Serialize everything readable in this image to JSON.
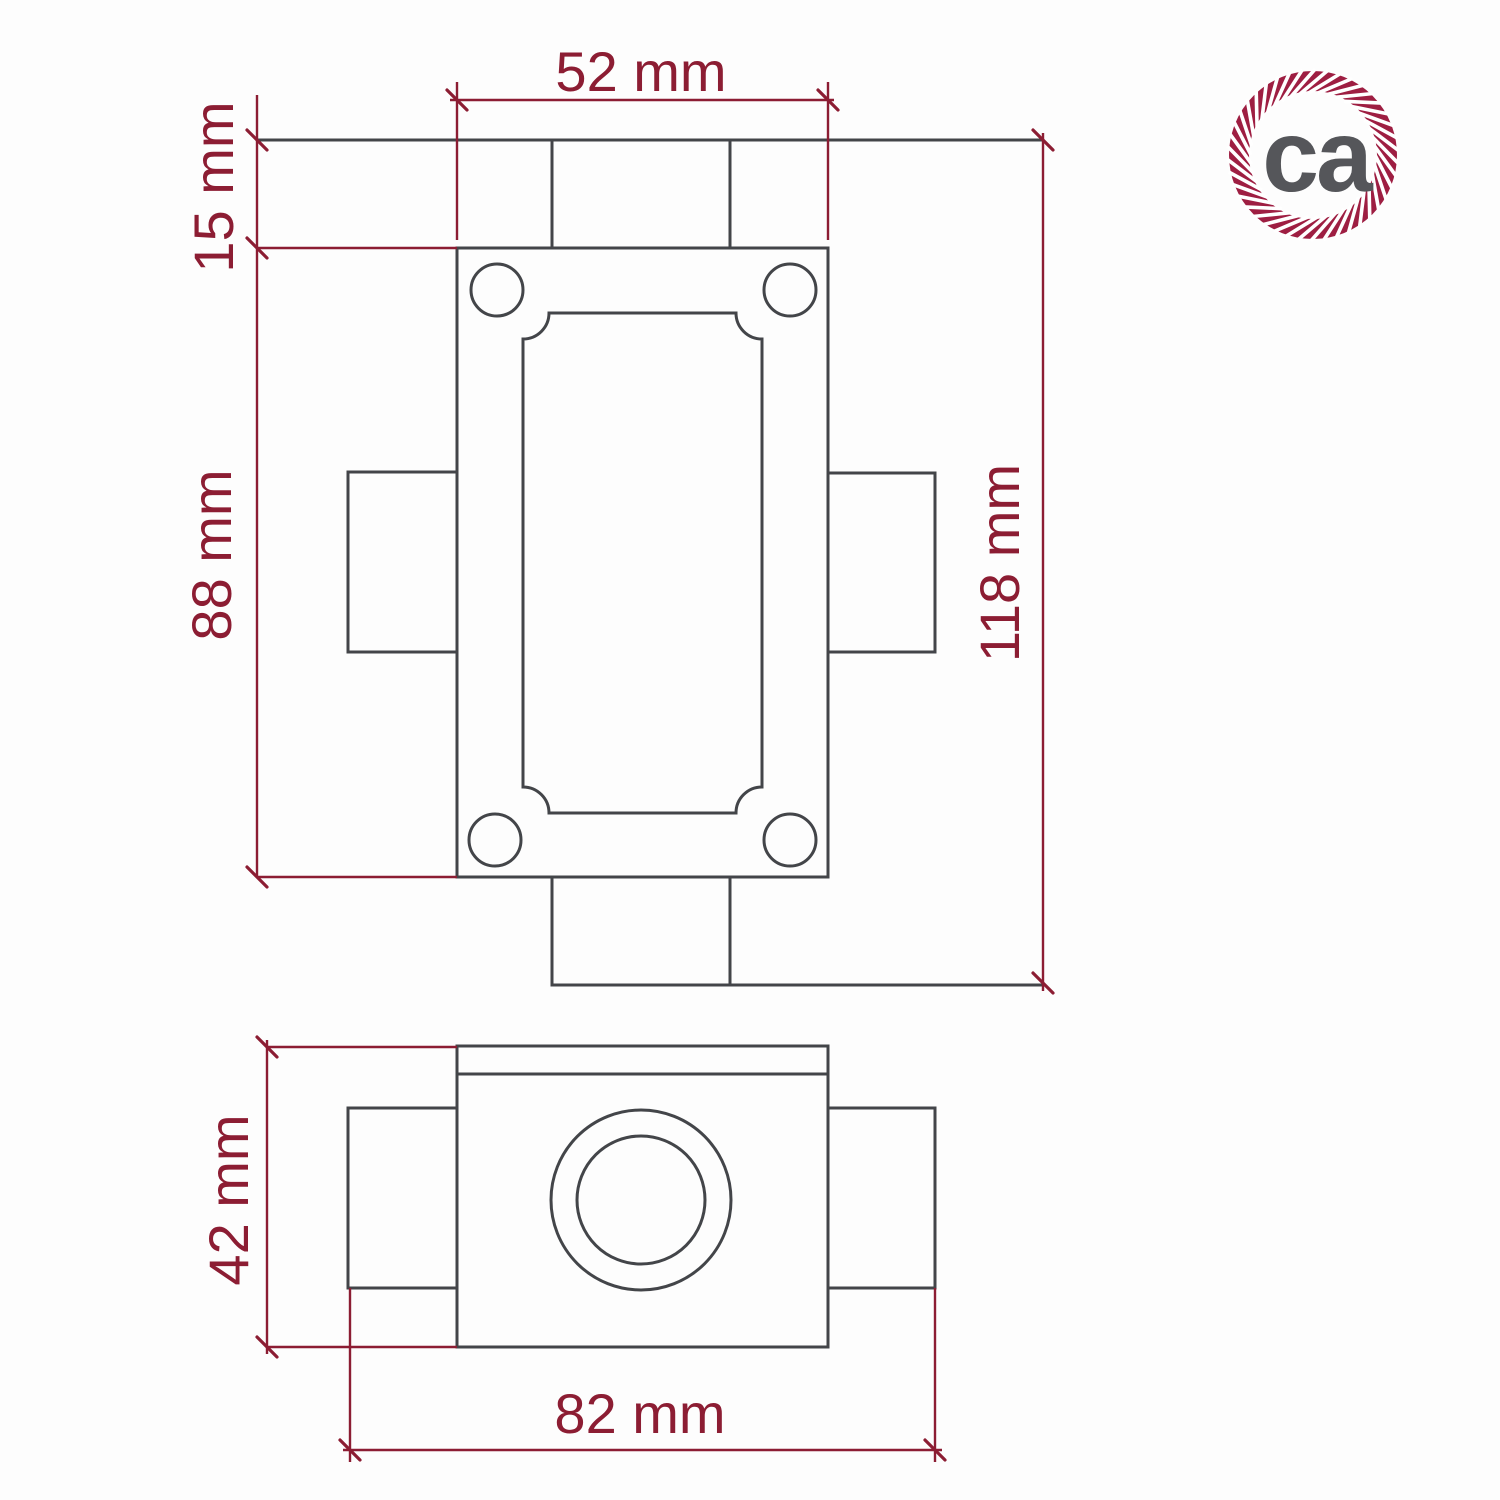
{
  "colors": {
    "dimension": "#8C1D33",
    "drawing": "#434549",
    "logo_ring": "#9E1E42",
    "logo_text": "#55565A",
    "background": "#FDFDFD"
  },
  "dims": {
    "top_view": [
      {
        "id": "box-width",
        "value": 52,
        "unit": "mm",
        "label": "52 mm",
        "orientation": "horizontal"
      },
      {
        "id": "neck-height",
        "value": 15,
        "unit": "mm",
        "label": "15 mm",
        "orientation": "vertical"
      },
      {
        "id": "plate-height",
        "value": 88,
        "unit": "mm",
        "label": "88 mm",
        "orientation": "vertical"
      },
      {
        "id": "overall-height",
        "value": 118,
        "unit": "mm",
        "label": "118 mm",
        "orientation": "vertical"
      }
    ],
    "side_view": [
      {
        "id": "body-height",
        "value": 42,
        "unit": "mm",
        "label": "42 mm",
        "orientation": "vertical"
      },
      {
        "id": "overall-width",
        "value": 82,
        "unit": "mm",
        "label": "82 mm",
        "orientation": "horizontal"
      }
    ]
  },
  "logo": {
    "text": "ca"
  }
}
